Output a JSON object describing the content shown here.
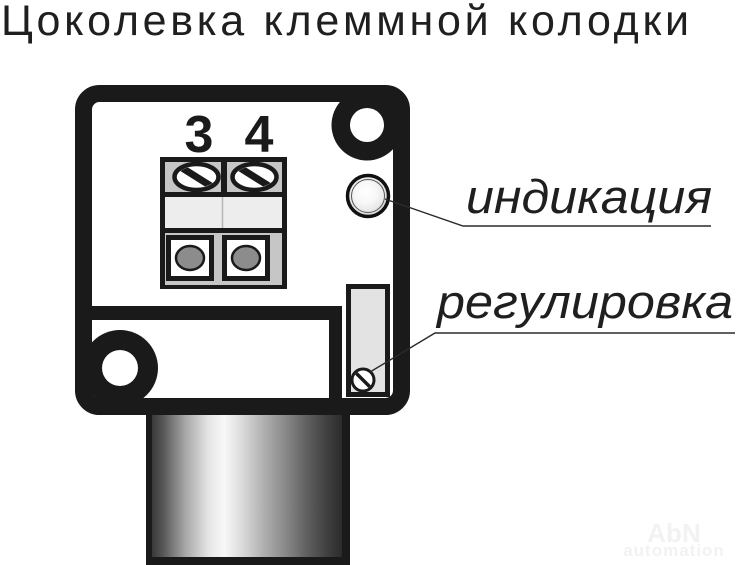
{
  "title": "Цоколевка клеммной колодки",
  "device": {
    "terminals": [
      {
        "number": "3"
      },
      {
        "number": "4"
      }
    ],
    "indication_label": "индикация",
    "adjustment_label": "регулировка"
  },
  "watermark": {
    "brand": "AbN",
    "sub": "automation"
  },
  "colors": {
    "outline": "#1a1a1a",
    "body_fill": "#ffffff",
    "screw_row_bg": "#c6c6c6",
    "mid_row_bg": "#ededed",
    "bottom_row_bg": "#c6c6c6",
    "wire_hole_fill": "#8c8c8c",
    "slot_fill": "#e3e3e3",
    "led_center": "#ffffff",
    "led_edge": "#d0d0d0",
    "stem_highlight": "#f8f8f8",
    "stem_dark": "#2b2b2b",
    "watermark": "#f2f2f2"
  }
}
